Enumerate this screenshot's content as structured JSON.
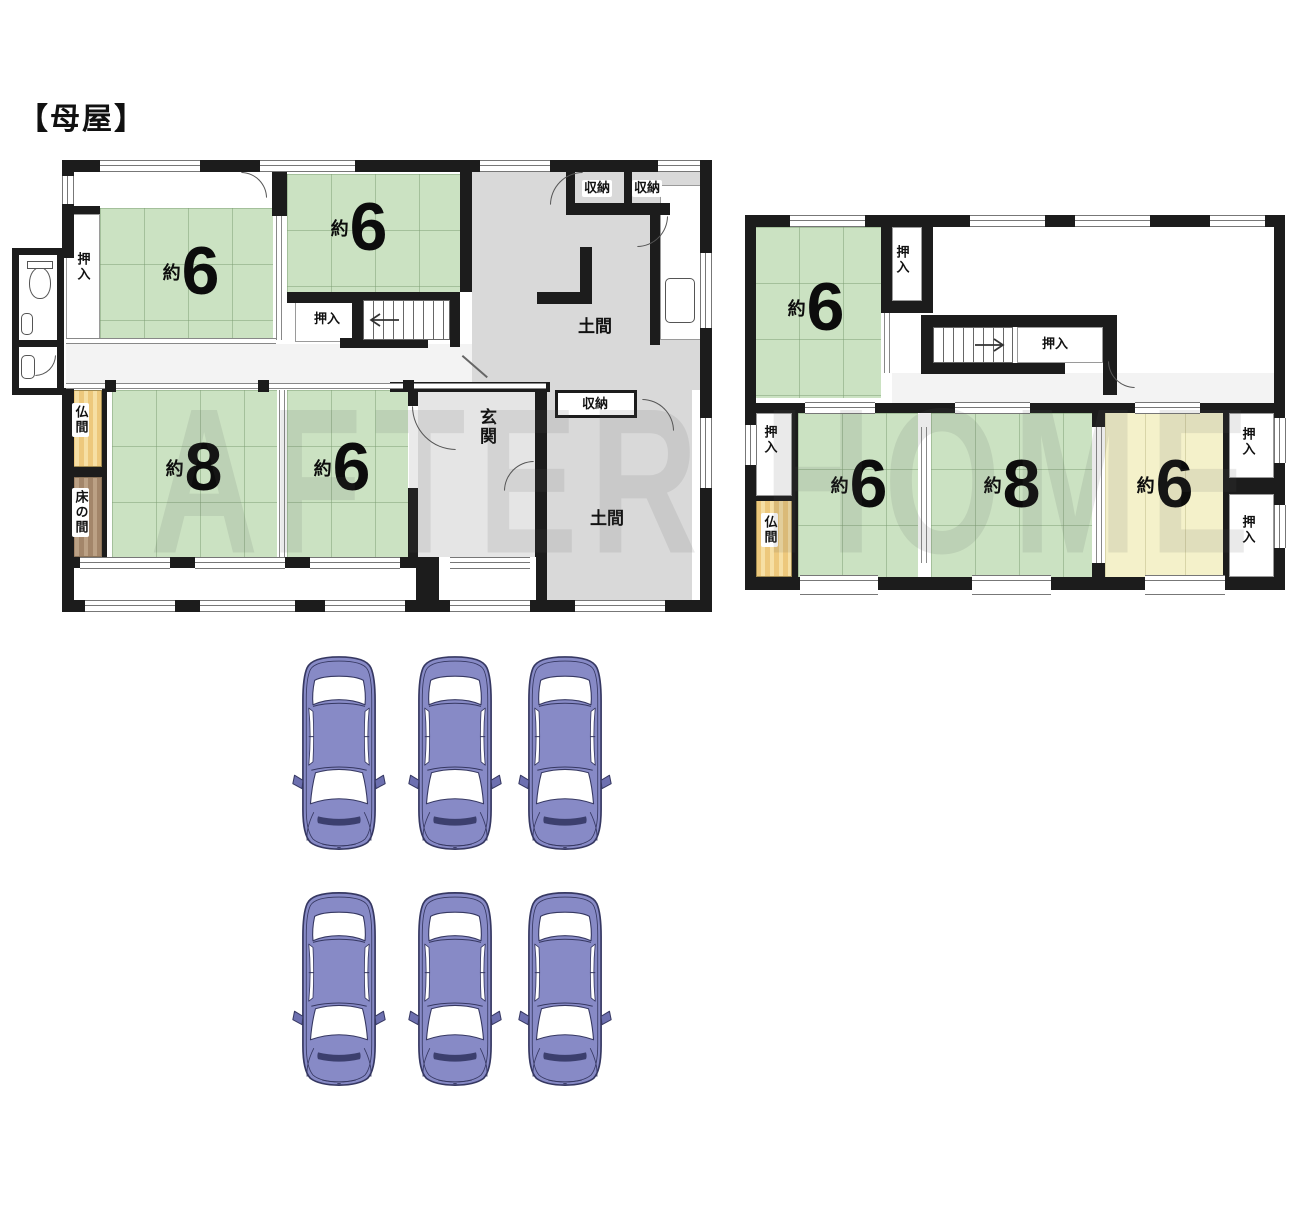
{
  "title": "【母屋】",
  "watermark": "AFTER HOME",
  "labels": {
    "oshiire": "押入",
    "shuno": "収納",
    "doma": "土間",
    "genkan": "玄関",
    "butsuma": "仏間",
    "tokonoma": "床の間"
  },
  "floor1": {
    "rooms": [
      {
        "id": "room-6-northwest",
        "approx": "約",
        "tatami": "6"
      },
      {
        "id": "room-6-north",
        "approx": "約",
        "tatami": "6"
      },
      {
        "id": "room-8-southwest",
        "approx": "約",
        "tatami": "8"
      },
      {
        "id": "room-6-south",
        "approx": "約",
        "tatami": "6"
      }
    ]
  },
  "floor2": {
    "rooms": [
      {
        "id": "room-6-northwest",
        "approx": "約",
        "tatami": "6"
      },
      {
        "id": "room-6-southwest",
        "approx": "約",
        "tatami": "6"
      },
      {
        "id": "room-8-south",
        "approx": "約",
        "tatami": "8"
      },
      {
        "id": "room-6-southeast",
        "approx": "約",
        "tatami": "6"
      }
    ]
  },
  "parking": {
    "car_count": 6
  },
  "colors": {
    "tatami_green": "#cbe2c2",
    "room_yellow": "#f4f1ca",
    "doma_gray": "#d9d9d9",
    "genkan_gray": "#e5e5e5",
    "butsuma_gold": "#edc87c",
    "tokonoma_brown": "#a3866a",
    "wall_black": "#1c1c1c",
    "car_body": "#878ac6",
    "car_outline": "#363862"
  }
}
